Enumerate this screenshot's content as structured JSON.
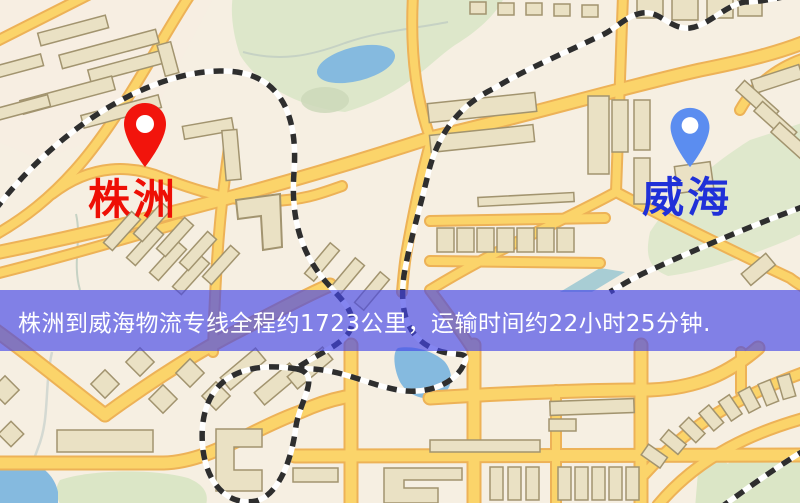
{
  "origin_marker": {
    "label": "株洲"
  },
  "destination_marker": {
    "label": "威海"
  },
  "banner": {
    "text": "株洲到威海物流专线全程约1723公里，运输时间约22小时25分钟."
  },
  "icons": {
    "origin_pin": "map-pin-icon",
    "destination_pin": "map-pin-icon"
  },
  "colors": {
    "origin_pin": "#f2140c",
    "origin_label": "#ee0f05",
    "destination_pin": "#5b8df0",
    "destination_label": "#2030d8",
    "banner_bg": "rgba(68,70,232,0.66)",
    "banner_text": "#ffffff",
    "map_background": "#f6efe2",
    "road_fill": "#fbd46a",
    "road_casing": "#edb257",
    "park_green": "#dde7ca",
    "water_blue": "#85badf",
    "building_fill": "#eae1c4",
    "building_stroke": "#a2946f",
    "railway_dark": "#2e2e2e"
  }
}
